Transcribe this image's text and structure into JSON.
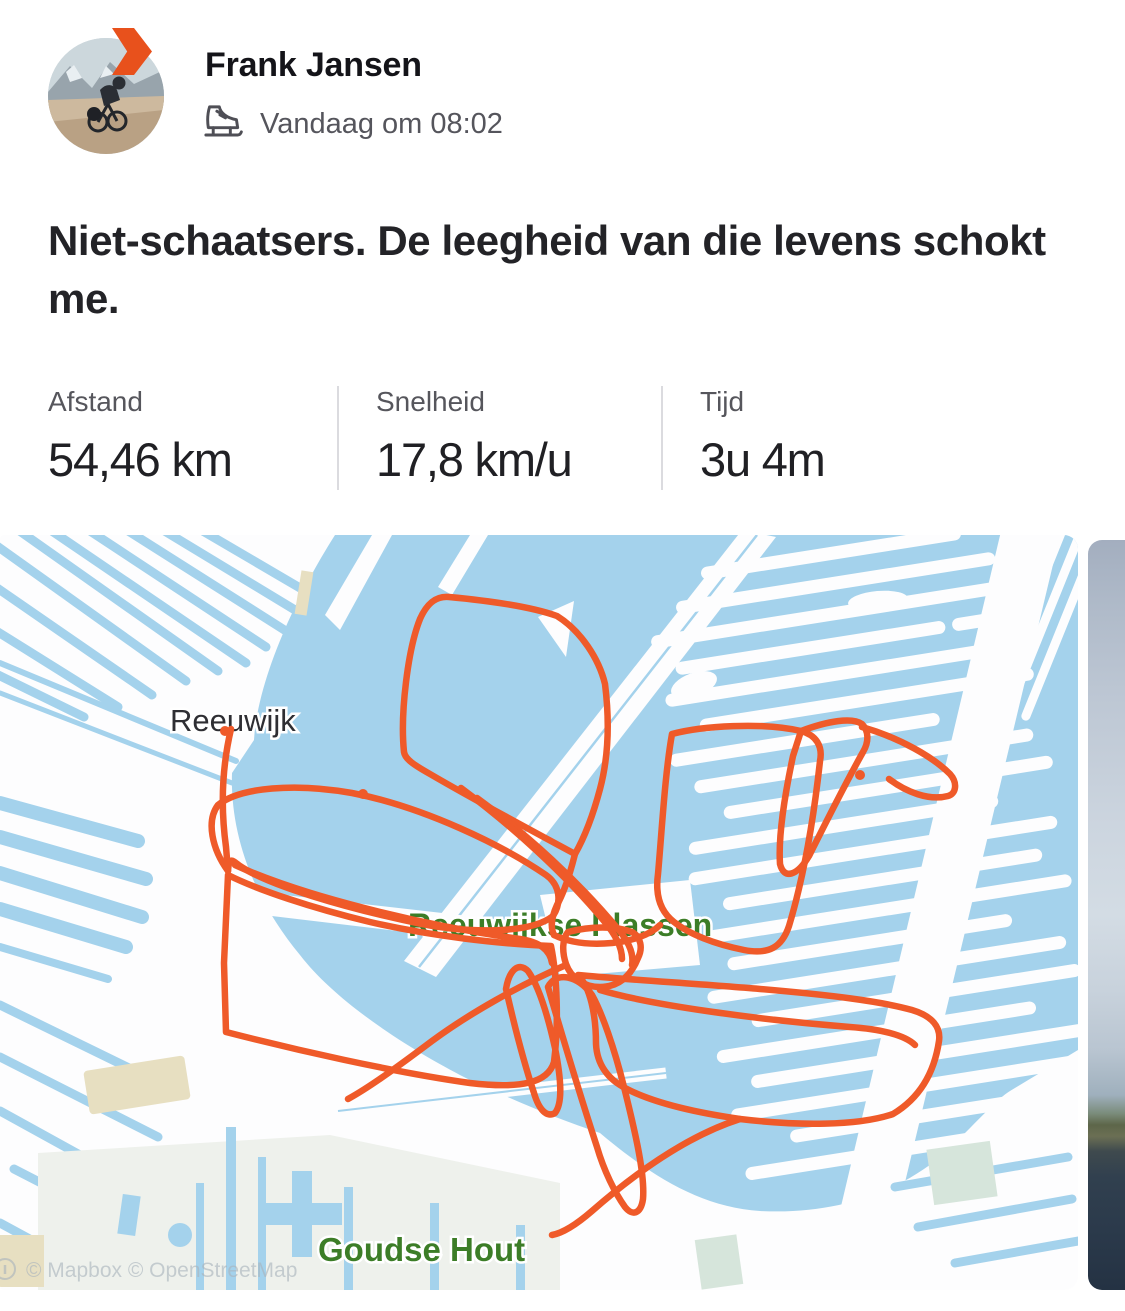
{
  "header": {
    "name": "Frank Jansen",
    "timestamp": "Vandaag om 08:02",
    "icons": {
      "badge": "forward-arrow-badge",
      "activity": "ice-skate-icon"
    }
  },
  "post": {
    "title": "Niet-schaatsers. De leegheid van die levens schokt me."
  },
  "stats": {
    "items": [
      {
        "label": "Afstand",
        "value": "54,46 km"
      },
      {
        "label": "Snelheid",
        "value": "17,8 km/u"
      },
      {
        "label": "Tijd",
        "value": "3u 4m"
      }
    ]
  },
  "map": {
    "labels": {
      "town": "Reeuwijk",
      "lake": "Reeuwijkse Plassen",
      "forest": "Goudse Hout"
    },
    "attribution": "© Mapbox © OpenStreetMap",
    "icons": {
      "attribution": "info-icon"
    },
    "colors": {
      "water": "#a4d2ec",
      "route": "#ef5a29",
      "label_green": "#3c7d27",
      "badge_orange": "#e8511c"
    }
  }
}
